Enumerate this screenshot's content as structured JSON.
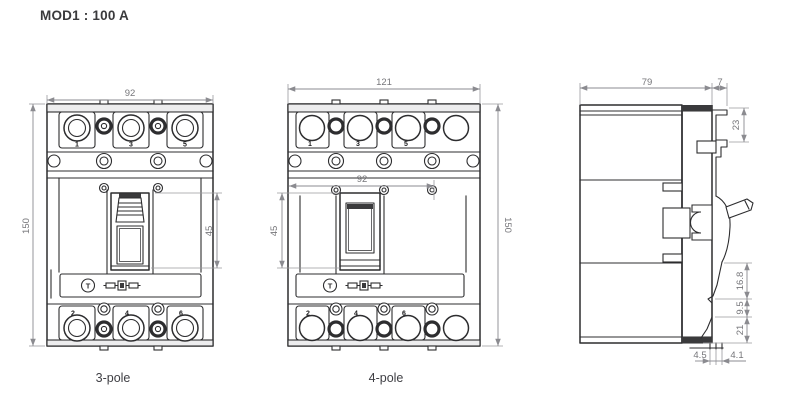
{
  "title": "MOD1 : 100 A",
  "captions": {
    "three_pole": "3-pole",
    "four_pole": "4-pole"
  },
  "three_pole": {
    "dim_width": "92",
    "dim_height": "150",
    "dim_handle_window": "45",
    "top_terminals": [
      "1",
      "3",
      "5"
    ],
    "bottom_terminals": [
      "2",
      "4",
      "6"
    ],
    "trip_button": "T"
  },
  "four_pole": {
    "dim_overall_width": "121",
    "dim_inner_width": "92",
    "dim_height": "150",
    "dim_handle_window": "45",
    "top_terminals": [
      "1",
      "3",
      "5"
    ],
    "bottom_terminals": [
      "2",
      "4",
      "6"
    ],
    "trip_button": "T"
  },
  "side_view": {
    "dim_depth": "79",
    "dim_front_cover": "7",
    "dim_top_offset": "23",
    "dim_lower_upper": "16.8",
    "dim_lower_mid": "9.5",
    "dim_lower_bottom": "21",
    "dim_foot_left": "4.5",
    "dim_foot_right": "4.1"
  },
  "colors": {
    "line": "#2d2d2f",
    "dimension": "#8b8b90",
    "dim_text": "#76767a",
    "title_text": "#3a3a3c"
  }
}
